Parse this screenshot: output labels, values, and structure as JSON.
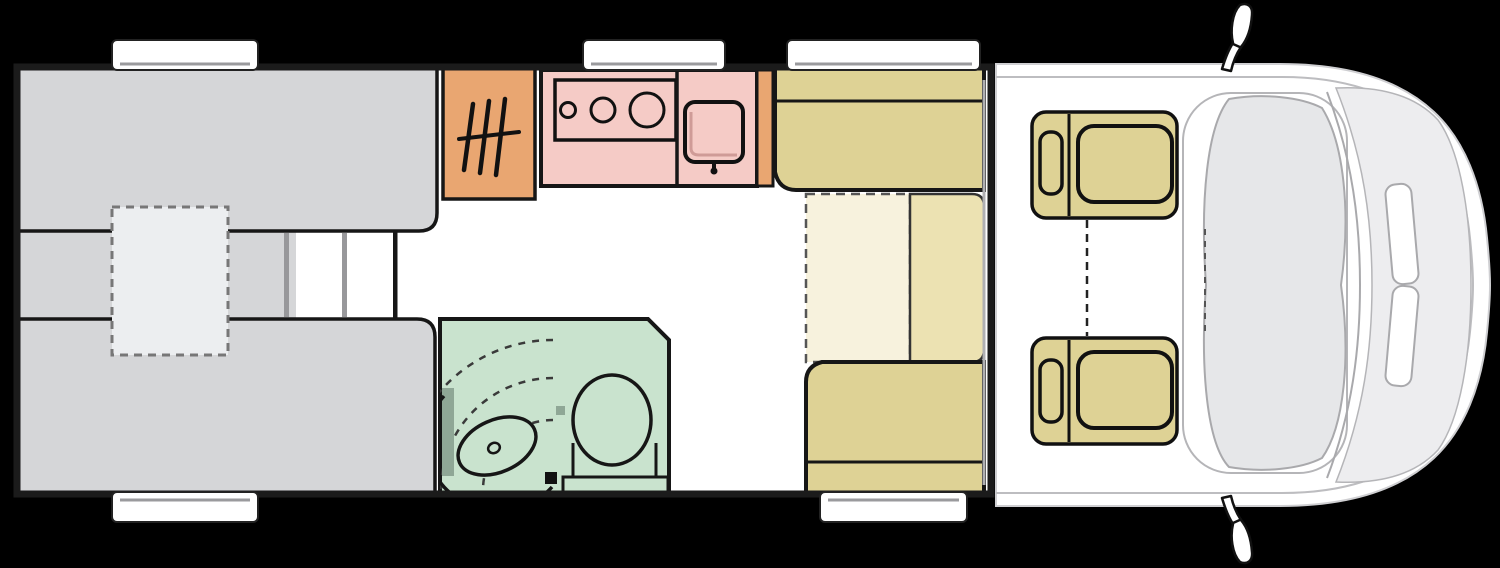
{
  "title": "Motorhome floor plan (top view)",
  "colors": {
    "background": "#000000",
    "wall": "#1b1b1b",
    "outline": "#161616",
    "floor": "#ffffff",
    "bed": "#d5d6d8",
    "bed_light": "#eceef0",
    "step_gray": "#98989b",
    "wardrobe": "#e9a671",
    "kitchen": "#f5cbc6",
    "kitchen_shadow": "#cf9b97",
    "bathroom": "#c9e3ce",
    "bath_dark": "#8fa796",
    "bench": "#ded295",
    "table_main": "#ece2b2",
    "table_ext": "#f7f2dd",
    "cab_body": "#ffffff",
    "cab_line": "#b5b5b8",
    "dash_fill": "#e6e7e9",
    "hood_fill": "#ededef",
    "window": "#ffffff"
  },
  "areas": {
    "bed_upper": "single-bed",
    "bed_lower": "single-bed",
    "night_console": "night-console",
    "wardrobe": "wardrobe",
    "kitchen": "kitchen-unit",
    "hob": "three-burner-hob",
    "sink": "kitchen-sink",
    "bathroom": "bathroom",
    "toilet": "toilet",
    "washbasin": "washbasin",
    "dinette_front_bench": "dinette-bench",
    "dinette_rear_bench": "dinette-bench",
    "table": "table",
    "table_extension": "table-extension",
    "cab_seat_upper": "swivel-cab-seat",
    "cab_seat_lower": "swivel-cab-seat",
    "window_count": 5,
    "mirror_count": 2
  }
}
